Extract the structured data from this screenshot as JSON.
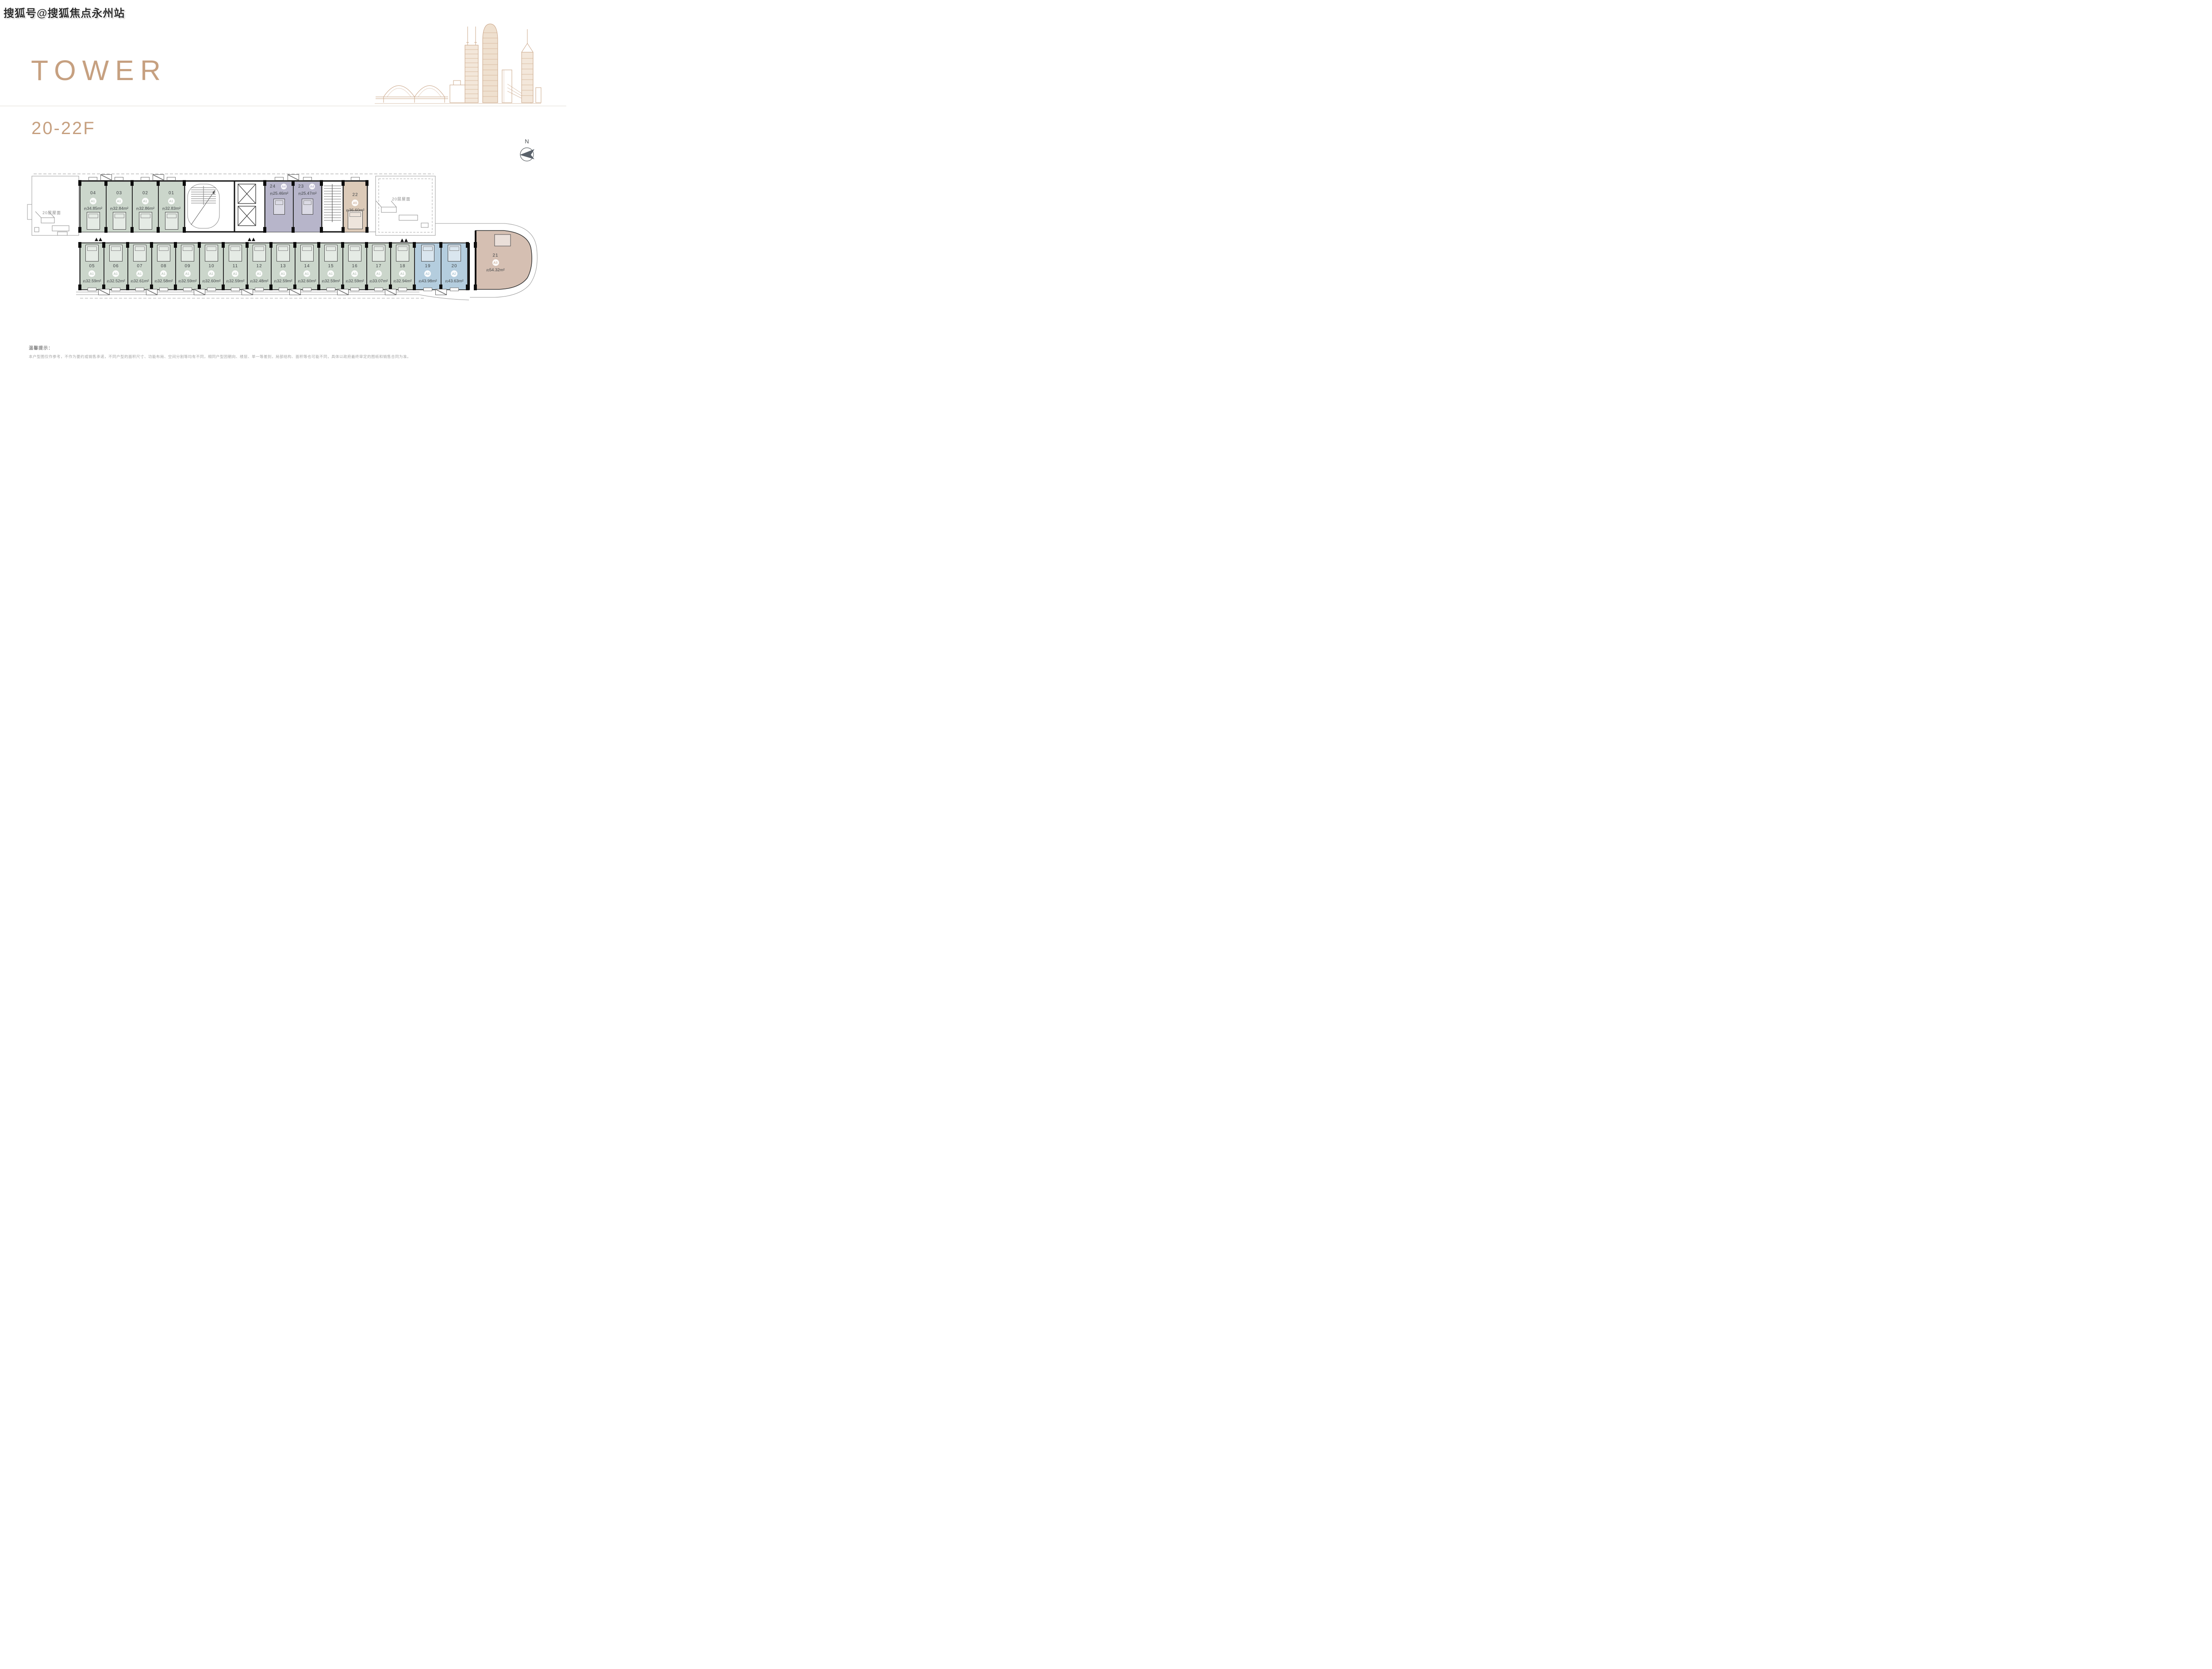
{
  "watermark": "搜狐号@搜狐焦点永州站",
  "header": {
    "title": "TOWER",
    "floor_range": "20-22F"
  },
  "north": {
    "label": "N"
  },
  "roof": {
    "left_label": "20层屋面",
    "right_label": "20层屋面"
  },
  "labels": {
    "area_prefix": "约",
    "area_unit": "m²"
  },
  "palette": {
    "brand": "#c6a080",
    "green": "#cbd6cb",
    "blue": "#b4cdde",
    "purple": "#b7b5ca",
    "tan": "#dccab8",
    "pink": "#d5bfb2",
    "wall": "#0d0d0d",
    "badge_A1": "#a3b2a5",
    "badge_A2": "#8fb2c6",
    "badge_A3": "#c29e86",
    "badge_A4": "#a6a2c3",
    "badge_A5": "#c29e86"
  },
  "units": {
    "top_green": [
      {
        "no": "04",
        "type": "A1",
        "area": "34.85"
      },
      {
        "no": "03",
        "type": "A1",
        "area": "32.84"
      },
      {
        "no": "02",
        "type": "A1",
        "area": "32.86"
      },
      {
        "no": "01",
        "type": "A1",
        "area": "32.83"
      }
    ],
    "purple": [
      {
        "no": "24",
        "type": "A4",
        "area": "25.46"
      },
      {
        "no": "23",
        "type": "A4",
        "area": "25.47"
      }
    ],
    "tan": {
      "no": "22",
      "type": "A5",
      "area": "36.60"
    },
    "bottom_green": [
      {
        "no": "05",
        "type": "A1",
        "area": "32.59"
      },
      {
        "no": "06",
        "type": "A1",
        "area": "32.52"
      },
      {
        "no": "07",
        "type": "A1",
        "area": "32.61"
      },
      {
        "no": "08",
        "type": "A1",
        "area": "32.58"
      },
      {
        "no": "09",
        "type": "A1",
        "area": "32.59"
      },
      {
        "no": "10",
        "type": "A1",
        "area": "32.60"
      },
      {
        "no": "11",
        "type": "A1",
        "area": "32.59"
      },
      {
        "no": "12",
        "type": "A1",
        "area": "32.48"
      },
      {
        "no": "13",
        "type": "A1",
        "area": "32.59"
      },
      {
        "no": "14",
        "type": "A1",
        "area": "32.60"
      },
      {
        "no": "15",
        "type": "A1",
        "area": "32.59"
      },
      {
        "no": "16",
        "type": "A1",
        "area": "32.59"
      },
      {
        "no": "17",
        "type": "A1",
        "area": "33.07"
      },
      {
        "no": "18",
        "type": "A1",
        "area": "32.94"
      }
    ],
    "blue": [
      {
        "no": "19",
        "type": "A2",
        "area": "43.98"
      },
      {
        "no": "20",
        "type": "A2",
        "area": "43.63"
      }
    ],
    "corner": {
      "no": "21",
      "type": "A3",
      "area": "54.32"
    }
  },
  "notice": {
    "title": "温馨提示：",
    "body": "本户型图仅作参考，不作为要约或销售承诺，不同户型的面积尺寸、功能布局、空间分割等均有不同，相同户型因朝向、楼层、单一等差别，局部结构、面积等也可能不同，具体以政府最终审定的图纸和销售合同为准。"
  }
}
